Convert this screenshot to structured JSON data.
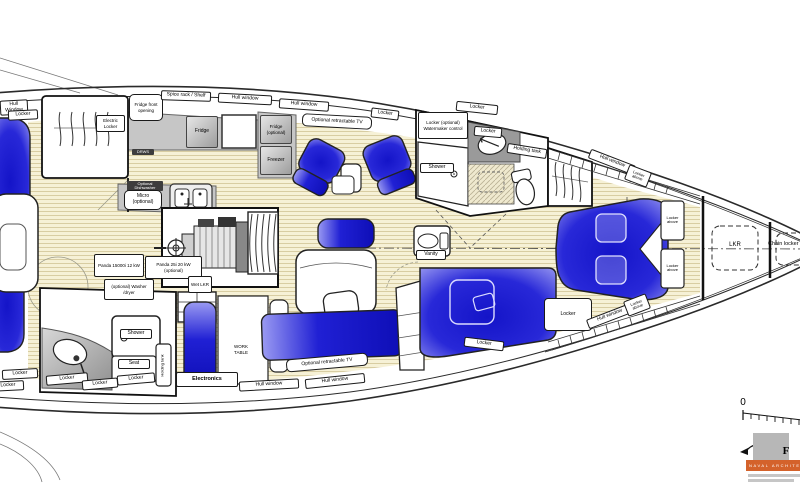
{
  "drawing": {
    "type": "yacht-interior-floor-plan",
    "orientation": "bow-right",
    "colors": {
      "berth_blue": "#1c1cd2",
      "berth_blue_light": "#a0a0f2",
      "floor_teak": "#f6f1d6",
      "floor_stripe": "#d8cda2",
      "counter_gray": "#c6c6c6",
      "dark_counter_gray": "#9a9a9a",
      "outline": "#1a1a1a",
      "logo_orange": "#d4622b"
    }
  },
  "labels": [
    {
      "name": "hull-window-stern-top",
      "text": "Hull Window"
    },
    {
      "name": "locker-stern-top",
      "text": "Locker"
    },
    {
      "name": "electric-locker",
      "text": "Electric Locker"
    },
    {
      "name": "fridge-front-opening",
      "text": "Fridge front opening"
    },
    {
      "name": "spice-rack-shelf",
      "text": "Spice rack / Shelf"
    },
    {
      "name": "hull-window-galley-1",
      "text": "Hull window"
    },
    {
      "name": "hull-window-galley-2",
      "text": "Hull window"
    },
    {
      "name": "locker-top-mid",
      "text": "Locker"
    },
    {
      "name": "tv-port",
      "text": "Optional retractable TV"
    },
    {
      "name": "fridge",
      "text": "Fridge"
    },
    {
      "name": "fridge-optional",
      "text": "Fridge (optional)"
    },
    {
      "name": "freezer",
      "text": "Freezer"
    },
    {
      "name": "drawers",
      "text": "DRWS"
    },
    {
      "name": "optional-dishwasher",
      "text": "Optional Dishwasher"
    },
    {
      "name": "micro-optional",
      "text": "Micro (optional)"
    },
    {
      "name": "locker-watermaker",
      "text": "Locker (optional) Watermaker control"
    },
    {
      "name": "locker-fwd-head",
      "text": "Locker"
    },
    {
      "name": "holding-tank-fwd",
      "text": "Holding tank"
    },
    {
      "name": "shower-fwd",
      "text": "Shower"
    },
    {
      "name": "hull-window-bow-top",
      "text": "Hull window"
    },
    {
      "name": "locker-above-bow-top",
      "text": "Locker above"
    },
    {
      "name": "locker-above-box-top",
      "text": "Locker above"
    },
    {
      "name": "locker-above-box-bottom",
      "text": "Locker above"
    },
    {
      "name": "lkr",
      "text": "LKR"
    },
    {
      "name": "chain-locker",
      "text": "Chain locker"
    },
    {
      "name": "vanity",
      "text": "Vanity"
    },
    {
      "name": "locker-midcabin-fwd",
      "text": "Locker"
    },
    {
      "name": "locker-midcabin-bottom",
      "text": "Locker"
    },
    {
      "name": "hull-window-bow-bottom",
      "text": "Hull window"
    },
    {
      "name": "locker-above-bow-bottom",
      "text": "Locker above"
    },
    {
      "name": "panda-15000i",
      "text": "Panda 15000i 12 kW"
    },
    {
      "name": "panda-25i",
      "text": "Panda 25i 20 kW (optional)"
    },
    {
      "name": "wet-lkr",
      "text": "Wet LKR"
    },
    {
      "name": "washer-dryer",
      "text": "(optional) Washer /dryer"
    },
    {
      "name": "shower-aft",
      "text": "Shower"
    },
    {
      "name": "seat-aft",
      "text": "Seat"
    },
    {
      "name": "holding-tank-aft",
      "text": "Holding tank"
    },
    {
      "name": "locker-aftdeck-1",
      "text": "Locker"
    },
    {
      "name": "locker-aftdeck-2",
      "text": "Locker"
    },
    {
      "name": "locker-afthead-1",
      "text": "Locker"
    },
    {
      "name": "locker-afthead-2",
      "text": "Locker"
    },
    {
      "name": "locker-afthead-3",
      "text": "Locker"
    },
    {
      "name": "electronics",
      "text": "Electronics"
    },
    {
      "name": "work-table",
      "text": "WORK TABLE"
    },
    {
      "name": "hull-window-bottom-1",
      "text": "Hull window"
    },
    {
      "name": "hull-window-bottom-2",
      "text": "Hull window"
    },
    {
      "name": "tv-starboard",
      "text": "Optional retractable TV"
    },
    {
      "name": "scale-zero",
      "text": "0"
    },
    {
      "name": "logo-letter",
      "text": "F"
    },
    {
      "name": "logo-banner",
      "text": "NAVAL ARCHITECTS"
    },
    {
      "name": "locker-fwd-head-top",
      "text": "Locker"
    }
  ]
}
